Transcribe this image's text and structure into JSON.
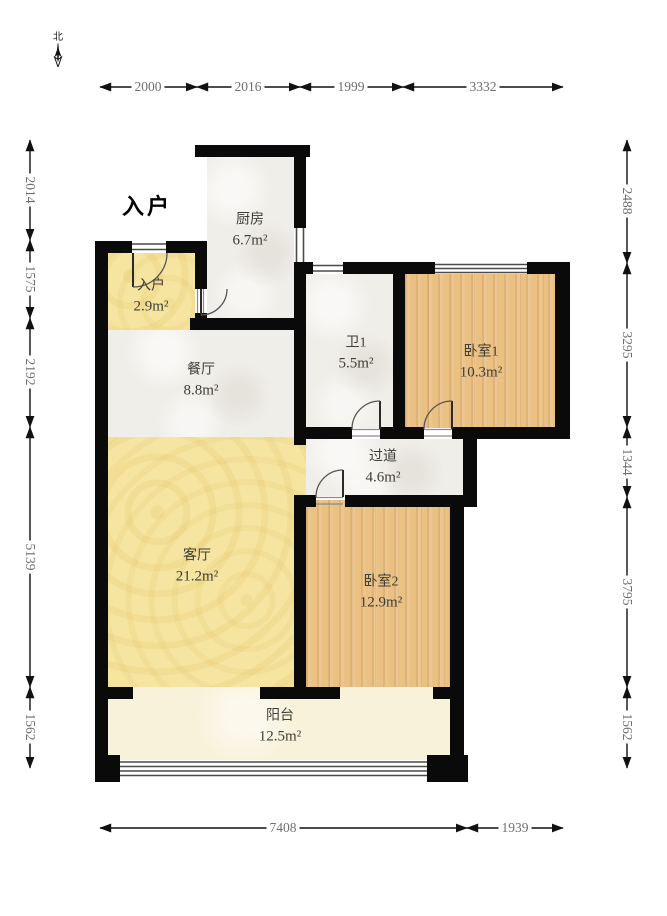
{
  "title": "户型图 (floor plan)",
  "compass": {
    "north_label": "北"
  },
  "entry_marker": {
    "label": "入户"
  },
  "rooms": [
    {
      "id": "entry",
      "name": "入户",
      "area": "2.9m²"
    },
    {
      "id": "kitchen",
      "name": "厨房",
      "area": "6.7m²"
    },
    {
      "id": "dining",
      "name": "餐厅",
      "area": "8.8m²"
    },
    {
      "id": "bath1",
      "name": "卫1",
      "area": "5.5m²"
    },
    {
      "id": "bedroom1",
      "name": "卧室1",
      "area": "10.3m²"
    },
    {
      "id": "hallway",
      "name": "过道",
      "area": "4.6m²"
    },
    {
      "id": "living",
      "name": "客厅",
      "area": "21.2m²"
    },
    {
      "id": "bedroom2",
      "name": "卧室2",
      "area": "12.9m²"
    },
    {
      "id": "balcony",
      "name": "阳台",
      "area": "12.5m²"
    }
  ],
  "dimensions": {
    "top": [
      "2000",
      "2016",
      "1999",
      "3332"
    ],
    "left": [
      "2014",
      "1575",
      "2192",
      "5139",
      "1562"
    ],
    "right": [
      "2488",
      "3295",
      "1344",
      "3795",
      "1562"
    ],
    "bottom": [
      "7408",
      "1939"
    ]
  },
  "colors": {
    "wall": "#0a0a0a",
    "marble": "#f0eee9",
    "yellow": "#f6e5a0",
    "wood": "#eac083",
    "cream": "#f8f2da",
    "window-line": "#4a4a4a"
  }
}
